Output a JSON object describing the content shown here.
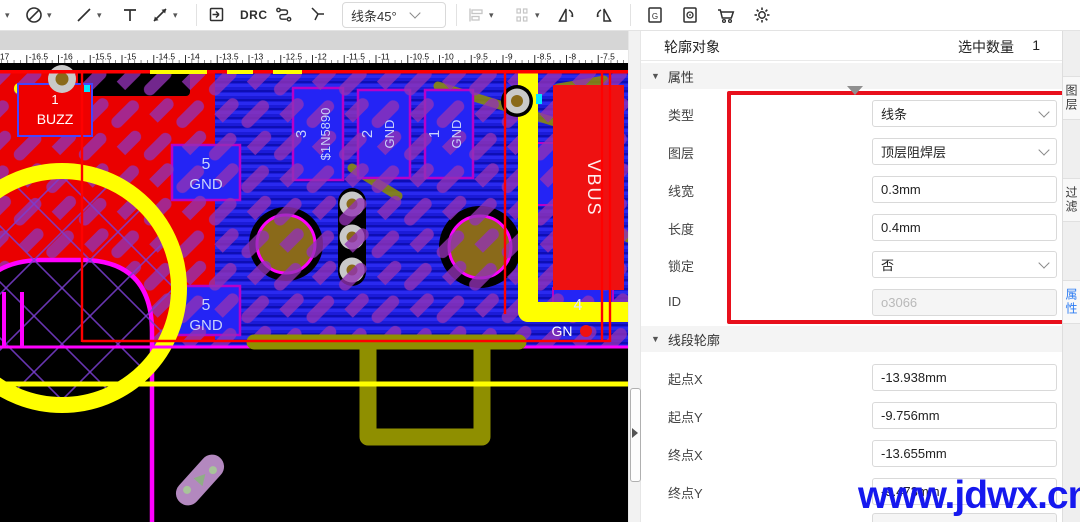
{
  "toolbar": {
    "drc_label": "DRC",
    "route_mode": "线条45°"
  },
  "panel": {
    "title": "轮廓对象",
    "count_label": "选中数量",
    "count": "1",
    "sec1": {
      "label": "属性",
      "rows": [
        {
          "label": "类型",
          "value": "线条"
        },
        {
          "label": "图层",
          "value": "顶层阻焊层"
        },
        {
          "label": "线宽",
          "value": "0.3mm"
        },
        {
          "label": "长度",
          "value": "0.4mm"
        },
        {
          "label": "锁定",
          "value": "否"
        },
        {
          "label": "ID",
          "value": "o3066"
        }
      ]
    },
    "sec2": {
      "label": "线段轮廓",
      "rows": [
        {
          "label": "起点X",
          "value": "-13.938mm"
        },
        {
          "label": "起点Y",
          "value": "-9.756mm"
        },
        {
          "label": "终点X",
          "value": "-13.655mm"
        },
        {
          "label": "终点Y",
          "value": "-9.473mm"
        }
      ]
    }
  },
  "side_tabs": [
    {
      "label": "图层"
    },
    {
      "label": "过滤"
    },
    {
      "label": "属性"
    }
  ],
  "canvas": {
    "ruler_labels": [
      "-17",
      "-16.5",
      "-16",
      "-15.5",
      "-15",
      "-14.5",
      "-14",
      "-13.5",
      "-13",
      "-12.5",
      "-12",
      "-11.5",
      "-11",
      "-10.5",
      "-10",
      "-9.5",
      "-9",
      "-8.5",
      "-8",
      "-7.5",
      "-7"
    ],
    "pads": {
      "buzz_num": "1",
      "buzz_name": "BUZZ",
      "gnd5a_num": "5",
      "gnd5a_name": "GND",
      "gnd5b_num": "5",
      "gnd5b_name": "GND",
      "d3_num": "3",
      "d3_name": "$1N5890",
      "g2_num": "2",
      "g2_name": "GND",
      "g1_num": "1",
      "g1_name": "GND",
      "p4_num": "4",
      "p4_name": "GN",
      "g_partial": "G",
      "vbus": "VBUS"
    }
  },
  "watermark": "www.jdwx.cn",
  "colors": {
    "annotation_red": "#e8101c",
    "watermark_blue": "#1518ee",
    "active_tab_blue": "#2a7af2",
    "pour_blue": "#1b1bd8",
    "pour_red": "#ea0000",
    "silk_yellow": "#ffff00",
    "mask_purple": "#9231b5",
    "edge_magenta": "#ff00ff",
    "copper_olive": "#8f8f00",
    "pad_brown": "#8a6a1a"
  }
}
